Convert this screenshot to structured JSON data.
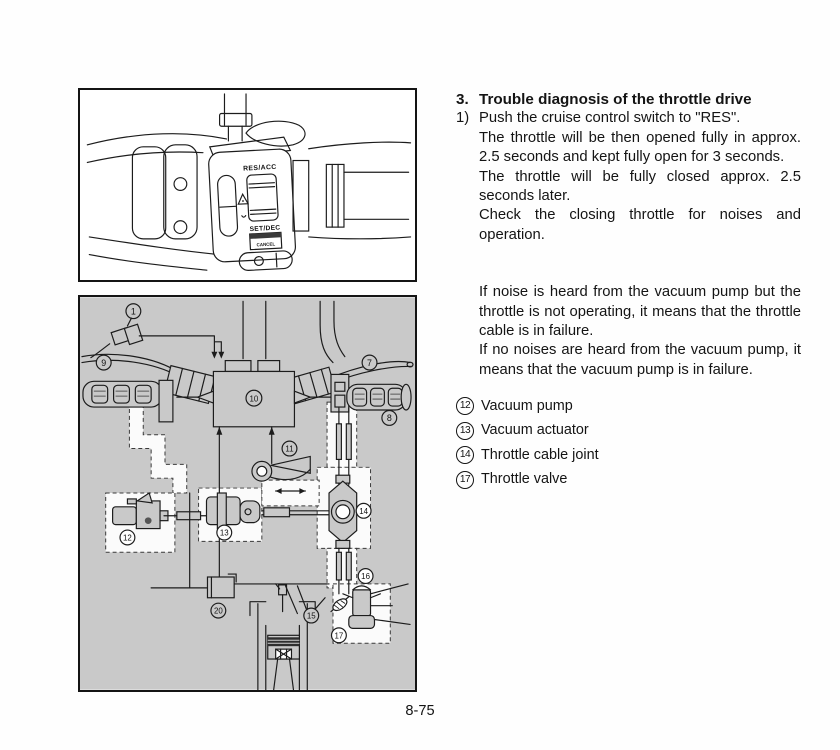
{
  "figure1": {
    "switch_labels": {
      "res_acc": "RES/ACC",
      "set_dec": "SET/DEC",
      "cancel": "CANCEL"
    }
  },
  "figure2": {
    "callouts": {
      "c1": "1",
      "c7": "7",
      "c8": "8",
      "c9": "9",
      "c10": "10",
      "c11": "11",
      "c12": "12",
      "c13": "13",
      "c14": "14",
      "c15": "15",
      "c16": "16",
      "c17": "17",
      "c20": "20"
    }
  },
  "content": {
    "heading_num": "3.",
    "heading": "Trouble diagnosis of the throttle drive",
    "step1_num": "1)",
    "step1": "Push the cruise control switch to \"RES\".",
    "para1": "The throttle will be then opened fully in approx. 2.5 seconds and kept fully open for 3 seconds.",
    "para2": "The throttle will be fully closed approx. 2.5 seconds later.",
    "para3": "Check the closing throttle for noises and operation.",
    "para4": "If noise is heard from the vacuum pump but the throttle is not operating, it means that the throttle cable is in failure.",
    "para5": "If no noises are heard from the vacuum pump, it means that the vacuum pump is in failure.",
    "legend": [
      {
        "num": "12",
        "label": "Vacuum pump"
      },
      {
        "num": "13",
        "label": "Vacuum actuator"
      },
      {
        "num": "14",
        "label": "Throttle cable joint"
      },
      {
        "num": "17",
        "label": "Throttle valve"
      }
    ]
  },
  "footer": {
    "page_number": "8-75"
  }
}
